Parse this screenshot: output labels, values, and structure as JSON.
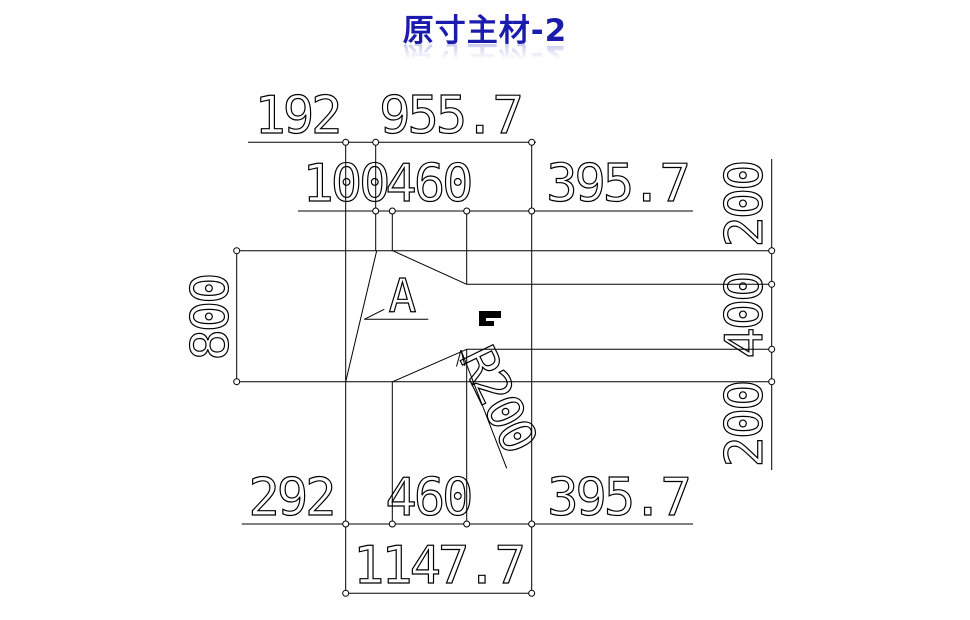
{
  "title": "原寸主材-2",
  "accent_color": "#1b1bad",
  "dimensions": {
    "top_outer": [
      "192",
      "955.7"
    ],
    "top_inner": [
      "100",
      "460",
      "395.7"
    ],
    "left_height": "800",
    "right_heights": [
      "200",
      "400",
      "200"
    ],
    "bottom_inner": [
      "292",
      "460",
      "395.7"
    ],
    "bottom_total": "1147.7",
    "radius_callout": "R200",
    "detail_label": "A"
  }
}
